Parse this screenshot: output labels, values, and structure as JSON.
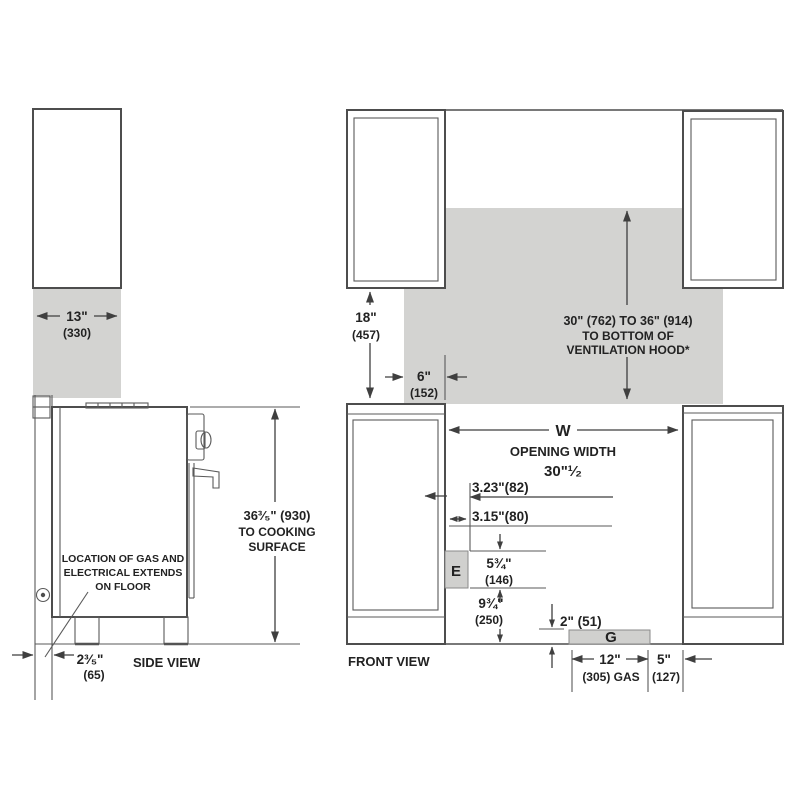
{
  "diagram": {
    "title_hint": "Range installation clearances",
    "colors": {
      "line": "#4d4d4d",
      "shaded_area": "#d3d3d1",
      "text": "#222222"
    },
    "side_view": {
      "label": "SIDE VIEW",
      "cabinet_depth_in": "13\"",
      "cabinet_depth_mm": "(330)",
      "height_line1": "36³⁄₅\" (930)",
      "height_line2": "TO COOKING",
      "height_line3": "SURFACE",
      "note_line1": "LOCATION OF GAS AND",
      "note_line2": "ELECTRICAL EXTENDS",
      "note_line3": "ON FLOOR",
      "wall_gap_in": "2³⁄₅\"",
      "wall_gap_mm": "(65)"
    },
    "front_view": {
      "label": "FRONT VIEW",
      "upper_gap_in": "18\"",
      "upper_gap_mm": "(457)",
      "splash_in": "6\"",
      "splash_mm": "(152)",
      "hood_line1": "30\" (762) TO 36\" (914)",
      "hood_line2": "TO BOTTOM OF",
      "hood_line3": "VENTILATION HOOD*",
      "opening_symbol": "W",
      "opening_label": "OPENING WIDTH",
      "opening_value": "30\"¹⁄₂",
      "dim_offset_a": "3.23\"(82)",
      "dim_offset_b": "3.15\"(80)",
      "electrical_box": "E",
      "elec_height_in": "5¾\"",
      "elec_height_mm": "(146)",
      "elec_floor_in": "9¾\"",
      "elec_floor_mm": "(250)",
      "gas_height": "2\" (51)",
      "gas_box": "G",
      "gas_width_in": "12\"",
      "gas_width_mm": "(305) GAS",
      "gas_offset_in": "5\"",
      "gas_offset_mm": "(127)"
    }
  }
}
